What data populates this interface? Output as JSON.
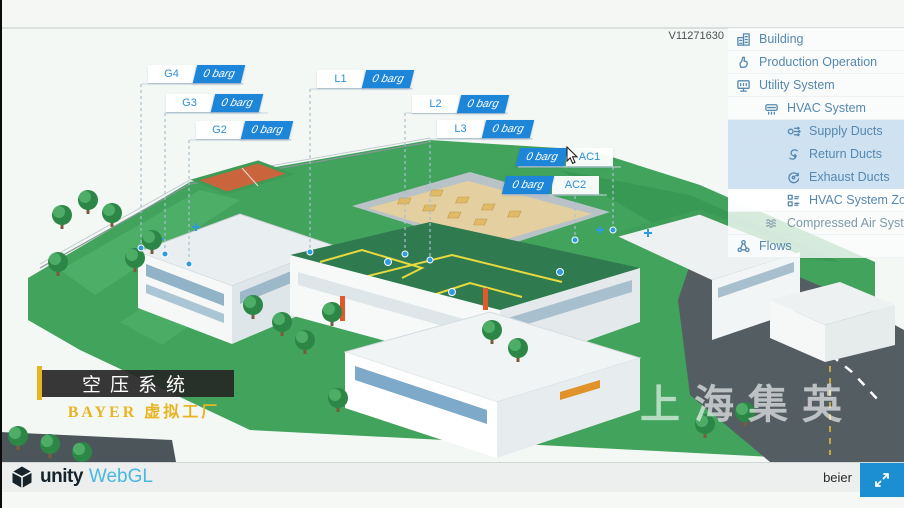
{
  "app": {
    "version": "V11271630"
  },
  "scene": {
    "watermark": "上海集英",
    "pressure_labels": [
      {
        "id": "G4",
        "value": "0 barg",
        "value_side": "right"
      },
      {
        "id": "G3",
        "value": "0 barg",
        "value_side": "right"
      },
      {
        "id": "G2",
        "value": "0 barg",
        "value_side": "right"
      },
      {
        "id": "L1",
        "value": "0 barg",
        "value_side": "right"
      },
      {
        "id": "L2",
        "value": "0 barg",
        "value_side": "right"
      },
      {
        "id": "L3",
        "value": "0 barg",
        "value_side": "right"
      },
      {
        "id": "AC1",
        "value": "0 barg",
        "value_side": "left"
      },
      {
        "id": "AC2",
        "value": "0 barg",
        "value_side": "left"
      }
    ]
  },
  "sidebar": {
    "items": [
      {
        "label": "Building",
        "icon": "building-icon",
        "level": 0,
        "active": false
      },
      {
        "label": "Production Operation",
        "icon": "production-operation-icon",
        "level": 0,
        "active": false
      },
      {
        "label": "Utility System",
        "icon": "utility-system-icon",
        "level": 0,
        "active": false
      },
      {
        "label": "HVAC System",
        "icon": "hvac-system-icon",
        "level": 1,
        "active": false
      },
      {
        "label": "Supply Ducts",
        "icon": "supply-ducts-icon",
        "level": 2,
        "active": true
      },
      {
        "label": "Return Ducts",
        "icon": "return-ducts-icon",
        "level": 2,
        "active": true
      },
      {
        "label": "Exhaust Ducts",
        "icon": "exhaust-ducts-icon",
        "level": 2,
        "active": true
      },
      {
        "label": "HVAC System Zones",
        "icon": "hvac-zones-icon",
        "level": 2,
        "active": false
      },
      {
        "label": "Compressed Air System",
        "icon": "compressed-air-icon",
        "level": 1,
        "active": false
      },
      {
        "label": "Flows",
        "icon": "flows-icon",
        "level": 0,
        "active": false
      }
    ]
  },
  "title_overlay": {
    "title": "空压系统",
    "subtitle": "BAYER 虚拟工厂"
  },
  "footer": {
    "unity_label": "unity",
    "webgl_label": "WebGL",
    "user": "beier"
  },
  "colors": {
    "accent_blue": "#1e86d8",
    "sidebar_text": "#5588b0",
    "highlight": "#cfe2f2",
    "grass": "#41a35c",
    "roof_green": "#2f7a4f",
    "road": "#535d62",
    "gold": "#e8b422",
    "webgl_blue": "#49b8e0"
  }
}
